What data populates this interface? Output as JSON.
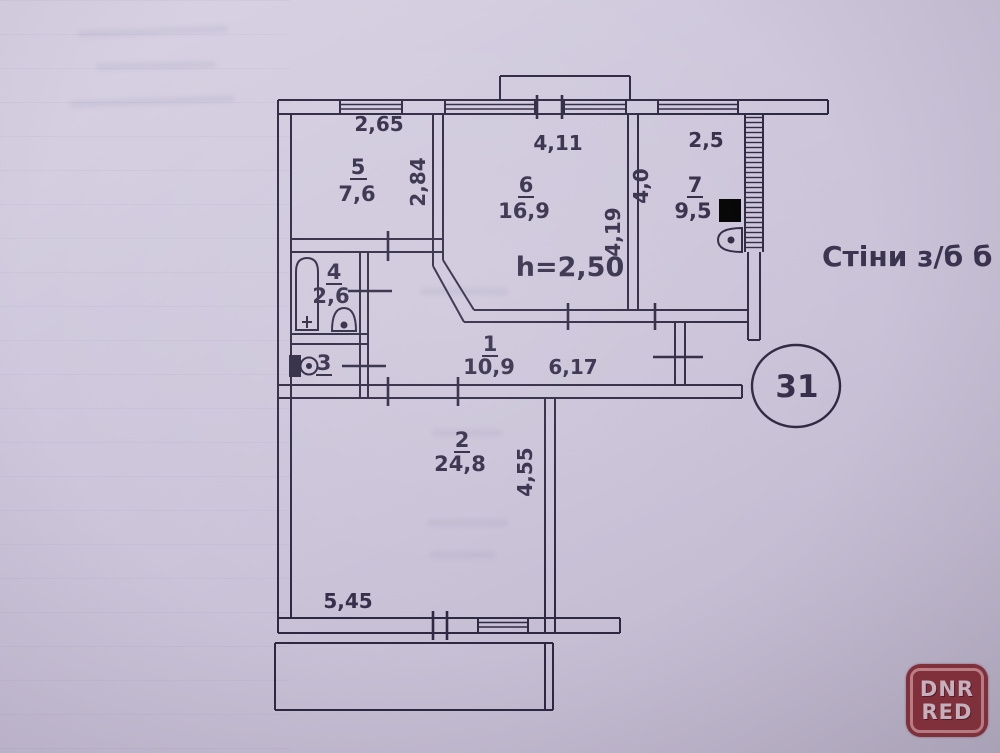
{
  "plan": {
    "note_walls": "Стіни з/б б",
    "ceiling_height": "h=2,50",
    "apartment_number": "31",
    "rooms": {
      "r1": {
        "num": "1",
        "area": "10,9"
      },
      "r2": {
        "num": "2",
        "area": "24,8"
      },
      "r3": {
        "num": "3"
      },
      "r4": {
        "num": "4",
        "area": "2,6"
      },
      "r5": {
        "num": "5",
        "area": "7,6"
      },
      "r6": {
        "num": "6",
        "area": "16,9"
      },
      "r7": {
        "num": "7",
        "area": "9,5"
      }
    },
    "dimensions": {
      "top_window_left": "2,65",
      "room5_depth": "2,84",
      "top_window_center": "4,11",
      "top_window_right": "2,5",
      "room7_depth": "4,0",
      "room6_depth": "4,19",
      "hallway_length": "6,17",
      "room2_depth": "4,55",
      "room2_width": "5,45"
    }
  },
  "watermark": {
    "line1": "DNR",
    "line2": "RED"
  },
  "colors": {
    "paper": "#ccc4d9",
    "ink": "#2d2841",
    "label": "#332d49",
    "watermark_bg": "#88323b",
    "watermark_border": "#c8858a",
    "watermark_text": "#d5c0ca"
  }
}
